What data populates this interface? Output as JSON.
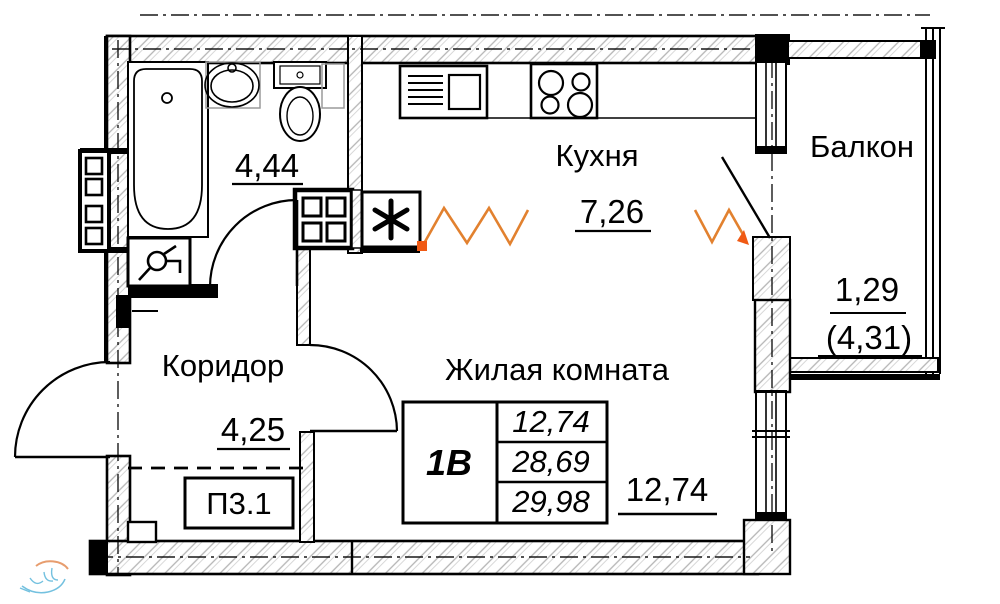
{
  "rooms": {
    "bathroom": {
      "area": "4,44"
    },
    "kitchen": {
      "label": "Кухня",
      "area": "7,26"
    },
    "corridor": {
      "label": "Коридор",
      "area": "4,25"
    },
    "living_room": {
      "label": "Жилая комната",
      "area": "12,74"
    },
    "balcony": {
      "label": "Балкон",
      "area": "1,29",
      "area_total": "(4,31)"
    }
  },
  "unit_label": "П3.1",
  "apartment_table": {
    "type_label": "1В",
    "values": [
      "12,74",
      "28,69",
      "29,98"
    ]
  },
  "icons": {
    "vent": "asterisk-vent-icon",
    "bath": "bathtub-icon",
    "sink": "washbasin-icon",
    "toilet": "toilet-icon",
    "washer": "washing-machine-tap-icon",
    "kitchen_sink": "kitchen-sink-unit-icon",
    "stove": "stove-burners-icon",
    "shaft": "riser-shaft-icon",
    "watermark": "developer-logo-watermark"
  },
  "colors": {
    "line": "#000000",
    "hatch": "#b4b4b4",
    "zigzag": "#e2812f",
    "zigzag_marker": "#f05a14",
    "watermark_blue": "#52b2d8",
    "watermark_orange": "#e2854a"
  }
}
